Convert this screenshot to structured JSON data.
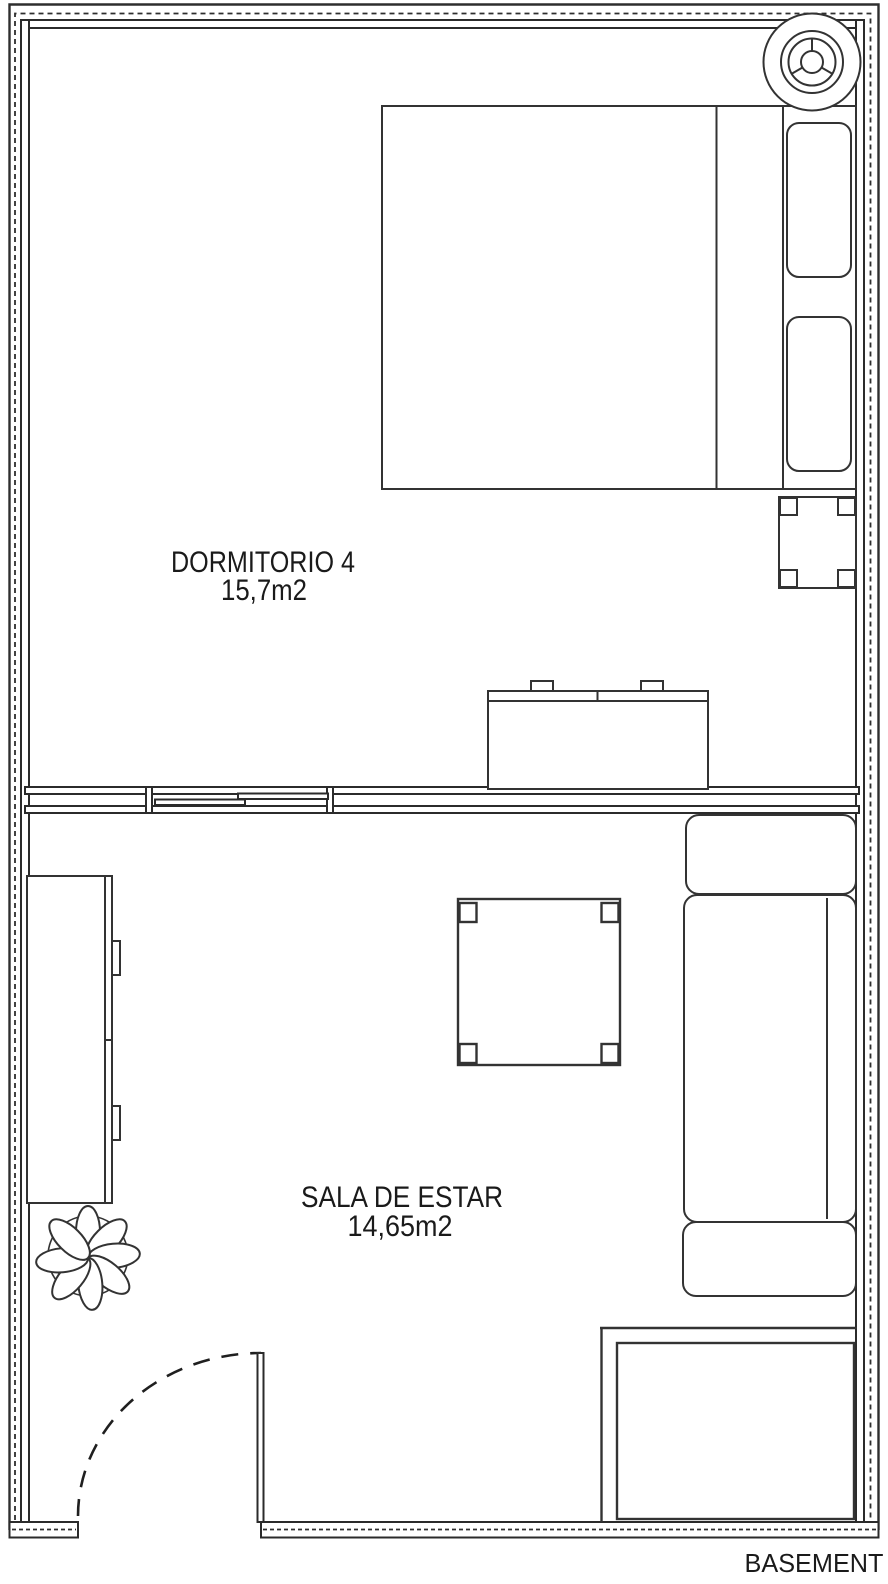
{
  "plan": {
    "floor_label": "BASEMENT",
    "rooms": [
      {
        "name": "DORMITORIO 4",
        "area": "15,7m2"
      },
      {
        "name": "SALA DE ESTAR",
        "area": "14,65m2"
      }
    ]
  },
  "colors": {
    "line": "#333333",
    "wall": "#2b2b2b",
    "background": "#ffffff",
    "text": "#1a1a1a"
  }
}
